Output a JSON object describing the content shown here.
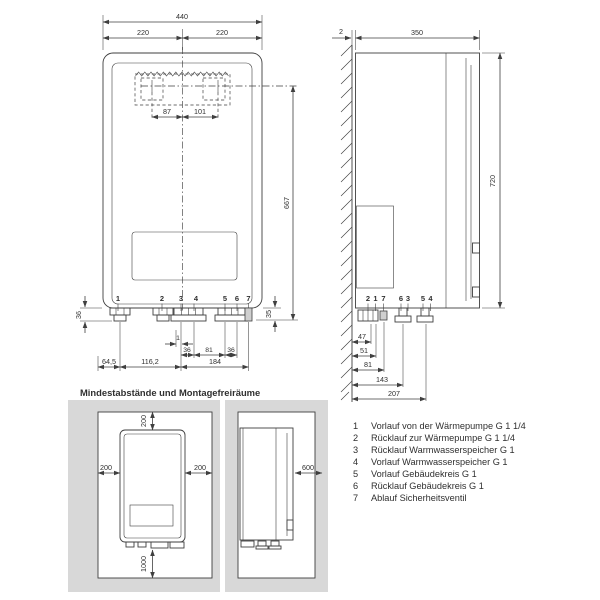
{
  "section_title": "Mindestabstände und Montagefreiräume",
  "front_view": {
    "dim_total_width": "440",
    "dim_width_left": "220",
    "dim_width_right": "220",
    "dim_hole_left": "87",
    "dim_hole_right": "101",
    "dim_height": "667",
    "dim_pipe_left": "36",
    "dim_pipe_right": "35",
    "dim_offset": "1",
    "dim_span_1": "36",
    "dim_span_2": "81",
    "dim_span_3": "36",
    "dim_bottom_1": "64,5",
    "dim_bottom_2": "116,2",
    "dim_bottom_3": "184",
    "connections": [
      "1",
      "2",
      "3",
      "4",
      "5",
      "6",
      "7"
    ]
  },
  "side_view": {
    "dim_wall_gap": "2",
    "dim_depth": "350",
    "dim_height": "720",
    "connections": [
      "2",
      "1",
      "7",
      "6",
      "3",
      "5",
      "4"
    ],
    "dim_rows": [
      "47",
      "51",
      "81",
      "143",
      "207"
    ]
  },
  "clearances": {
    "front": {
      "top": "200",
      "left": "200",
      "right": "200",
      "bottom": "1000"
    },
    "side": {
      "front": "600"
    }
  },
  "legend": [
    {
      "num": "1",
      "label": "Vorlauf von der Wärmepumpe G 1 1/4"
    },
    {
      "num": "2",
      "label": "Rücklauf zur Wärmepumpe G 1 1/4"
    },
    {
      "num": "3",
      "label": "Rücklauf Warmwasserspeicher G 1"
    },
    {
      "num": "4",
      "label": "Vorlauf Warmwasserspeicher G 1"
    },
    {
      "num": "5",
      "label": "Vorlauf Gebäudekreis G 1"
    },
    {
      "num": "6",
      "label": "Rücklauf Gebäudekreis G 1"
    },
    {
      "num": "7",
      "label": "Ablauf Sicherheitsventil"
    }
  ]
}
